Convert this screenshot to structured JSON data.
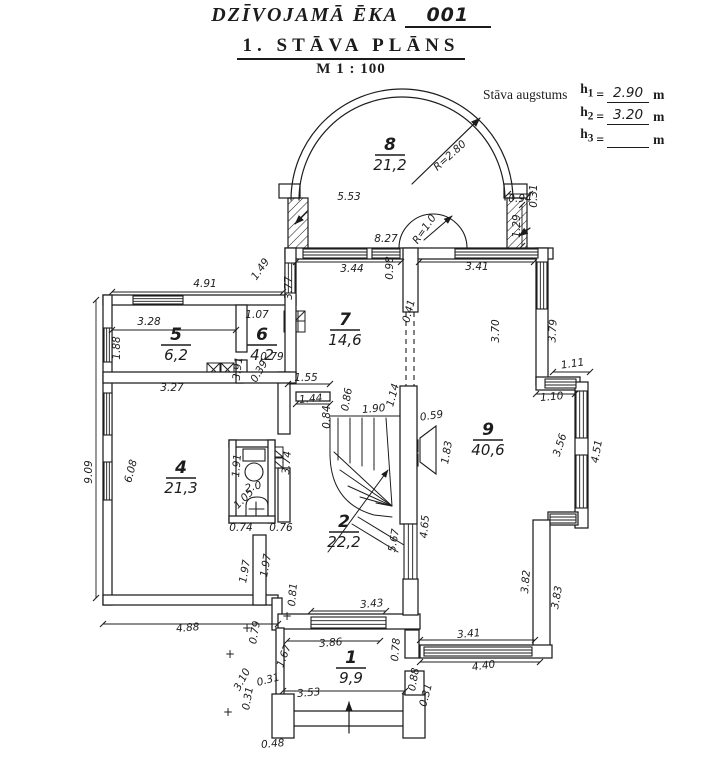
{
  "header": {
    "title": "DZĪVOJAMĀ ĒKA",
    "building_no": "001",
    "subtitle": "1. STĀVA PLĀNS",
    "scale": "M 1 : 100"
  },
  "heights": {
    "label": "Stāva augstums",
    "unit": "m",
    "rows": [
      {
        "sym": "h",
        "sub": "1",
        "value": "2.90"
      },
      {
        "sym": "h",
        "sub": "2",
        "value": "3.20"
      },
      {
        "sym": "h",
        "sub": "3",
        "value": ""
      }
    ]
  },
  "plan": {
    "ink": "#1c1c1c",
    "paper": "#ffffff",
    "rooms": [
      {
        "number": "8",
        "area": "21,2",
        "x": 390,
        "y": 155
      },
      {
        "number": "7",
        "area": "14,6",
        "x": 345,
        "y": 330
      },
      {
        "number": "5",
        "area": "6,2",
        "x": 176,
        "y": 345
      },
      {
        "number": "6",
        "area": "4,2",
        "x": 262,
        "y": 345
      },
      {
        "number": "4",
        "area": "21,3",
        "x": 181,
        "y": 478
      },
      {
        "number": "9",
        "area": "40,6",
        "x": 488,
        "y": 440
      },
      {
        "number": "2",
        "area": "22,2",
        "x": 344,
        "y": 532
      },
      {
        "number": "1",
        "area": "9,9",
        "x": 351,
        "y": 668
      }
    ],
    "dimensions": [
      {
        "t": "5.53",
        "x": 349,
        "y": 200,
        "r": 0
      },
      {
        "t": "8.27",
        "x": 386,
        "y": 242,
        "r": 0
      },
      {
        "t": "R=2.80",
        "x": 452,
        "y": 158,
        "r": -42
      },
      {
        "t": "R=1.0",
        "x": 427,
        "y": 231,
        "r": -55
      },
      {
        "t": "0.94",
        "x": 520,
        "y": 202,
        "r": 0
      },
      {
        "t": "0.31",
        "x": 537,
        "y": 196,
        "r": -90
      },
      {
        "t": "1.29",
        "x": 520,
        "y": 226,
        "r": -90
      },
      {
        "t": "3.44",
        "x": 352,
        "y": 272,
        "r": 0
      },
      {
        "t": "3.41",
        "x": 477,
        "y": 270,
        "r": 0
      },
      {
        "t": "0.98",
        "x": 393,
        "y": 268,
        "r": -90
      },
      {
        "t": "1.49",
        "x": 263,
        "y": 271,
        "r": -55
      },
      {
        "t": "4.91",
        "x": 205,
        "y": 287,
        "r": 0
      },
      {
        "t": "3.77",
        "x": 292,
        "y": 288,
        "r": -90
      },
      {
        "t": "3.28",
        "x": 149,
        "y": 325,
        "r": 0
      },
      {
        "t": "1.07",
        "x": 257,
        "y": 318,
        "r": 0
      },
      {
        "t": "1.88",
        "x": 120,
        "y": 348,
        "r": -90
      },
      {
        "t": "0.79",
        "x": 272,
        "y": 360,
        "r": 0
      },
      {
        "t": "0.39",
        "x": 262,
        "y": 373,
        "r": -60
      },
      {
        "t": "3.91",
        "x": 241,
        "y": 369,
        "r": -83
      },
      {
        "t": "3.27",
        "x": 172,
        "y": 391,
        "r": 0
      },
      {
        "t": "3.70",
        "x": 499,
        "y": 331,
        "r": -90
      },
      {
        "t": "3.79",
        "x": 556,
        "y": 331,
        "r": -87
      },
      {
        "t": "1.11",
        "x": 573,
        "y": 367,
        "r": -8
      },
      {
        "t": "1.10",
        "x": 552,
        "y": 400,
        "r": -5
      },
      {
        "t": "3.56",
        "x": 563,
        "y": 446,
        "r": -72
      },
      {
        "t": "4.51",
        "x": 600,
        "y": 452,
        "r": -80
      },
      {
        "t": "0.41",
        "x": 412,
        "y": 312,
        "r": -75
      },
      {
        "t": "1.55",
        "x": 306,
        "y": 381,
        "r": 0
      },
      {
        "t": "1.44",
        "x": 311,
        "y": 402,
        "r": -5
      },
      {
        "t": "0.86",
        "x": 350,
        "y": 400,
        "r": -80
      },
      {
        "t": "0.84",
        "x": 330,
        "y": 417,
        "r": -90
      },
      {
        "t": "1.90",
        "x": 374,
        "y": 412,
        "r": -5
      },
      {
        "t": "1.14",
        "x": 396,
        "y": 396,
        "r": -75
      },
      {
        "t": "0.59",
        "x": 432,
        "y": 419,
        "r": -8
      },
      {
        "t": "1.83",
        "x": 450,
        "y": 453,
        "r": -80
      },
      {
        "t": "3.74",
        "x": 290,
        "y": 463,
        "r": -85
      },
      {
        "t": "9.09",
        "x": 92,
        "y": 472,
        "r": -90
      },
      {
        "t": "6.08",
        "x": 134,
        "y": 472,
        "r": -75
      },
      {
        "t": "1.91",
        "x": 240,
        "y": 466,
        "r": -85
      },
      {
        "t": "2.0",
        "x": 254,
        "y": 490,
        "r": -15
      },
      {
        "t": "1.05",
        "x": 246,
        "y": 501,
        "r": -45
      },
      {
        "t": "0.74",
        "x": 241,
        "y": 531,
        "r": 0
      },
      {
        "t": "0.76",
        "x": 281,
        "y": 531,
        "r": 0
      },
      {
        "t": "5.67",
        "x": 397,
        "y": 541,
        "r": -80
      },
      {
        "t": "4.65",
        "x": 428,
        "y": 527,
        "r": -85
      },
      {
        "t": "1.97",
        "x": 248,
        "y": 572,
        "r": -80
      },
      {
        "t": "1.97",
        "x": 269,
        "y": 566,
        "r": -80
      },
      {
        "t": "0.81",
        "x": 296,
        "y": 595,
        "r": -85
      },
      {
        "t": "3.43",
        "x": 372,
        "y": 607,
        "r": -5
      },
      {
        "t": "4.88",
        "x": 188,
        "y": 631,
        "r": -5
      },
      {
        "t": "0.79",
        "x": 258,
        "y": 633,
        "r": -80
      },
      {
        "t": "3.86",
        "x": 331,
        "y": 646,
        "r": -5
      },
      {
        "t": "1.67",
        "x": 287,
        "y": 657,
        "r": -70
      },
      {
        "t": "3.82",
        "x": 529,
        "y": 582,
        "r": -85
      },
      {
        "t": "3.83",
        "x": 560,
        "y": 598,
        "r": -80
      },
      {
        "t": "3.41",
        "x": 469,
        "y": 637,
        "r": -5
      },
      {
        "t": "4.40",
        "x": 484,
        "y": 669,
        "r": -8
      },
      {
        "t": "0.78",
        "x": 399,
        "y": 650,
        "r": -85
      },
      {
        "t": "3.10",
        "x": 245,
        "y": 681,
        "r": -62
      },
      {
        "t": "0.31",
        "x": 269,
        "y": 683,
        "r": -15
      },
      {
        "t": "0.31",
        "x": 251,
        "y": 699,
        "r": -80
      },
      {
        "t": "3.53",
        "x": 309,
        "y": 696,
        "r": -5
      },
      {
        "t": "0.88",
        "x": 417,
        "y": 680,
        "r": -80
      },
      {
        "t": "0.31",
        "x": 429,
        "y": 696,
        "r": -75
      },
      {
        "t": "0.48",
        "x": 273,
        "y": 747,
        "r": -5
      }
    ],
    "marks": [
      {
        "t": "+",
        "x": 247,
        "y": 632
      },
      {
        "t": "+",
        "x": 230,
        "y": 658
      },
      {
        "t": "+",
        "x": 228,
        "y": 716
      },
      {
        "t": "+",
        "x": 287,
        "y": 620
      }
    ]
  }
}
